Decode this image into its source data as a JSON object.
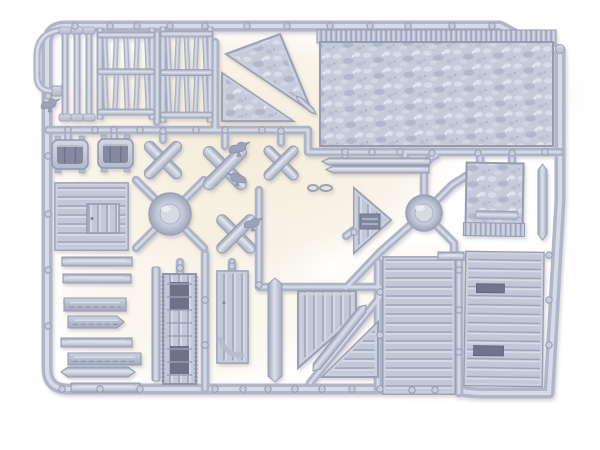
{
  "scene": {
    "description": "Photograph of a light grey plastic injection-moulded sprue (model kit frame) holding wooden-terrain parts: plank panels, picket fence gates, thatched roof sections, X-shaped barricade braces, posts, troughs, a ladder, doors and small perched crows, on a plain white background.",
    "palette": {
      "background": "#ffffff",
      "surface_tint": "#f3ebd6",
      "plastic_base": "#c3c8d8",
      "plastic_highlight": "#dde1ea",
      "plastic_shadow": "#9aa1b8",
      "plastic_dark": "#6f7489"
    }
  },
  "parts": [
    {
      "name": "hanging-hook",
      "kind": "stroke",
      "d": "M62,30 Q37,32 37,56 L37,76 Q37,89 49,91 L58,91",
      "w": 7
    },
    {
      "name": "hook-foot",
      "kind": "rect",
      "x": 52,
      "y": 86,
      "w": 10,
      "h": 10,
      "grad": "p"
    },
    {
      "name": "crow-figure-left",
      "kind": "crow",
      "x": 40,
      "y": 98,
      "s": 1.0,
      "flip": false
    },
    {
      "name": "fence-posts",
      "kind": "posts",
      "x": 62,
      "y": 27,
      "w": 30,
      "h": 94,
      "n": 3
    },
    {
      "name": "fence-gate-a",
      "kind": "gate",
      "x": 97,
      "y": 26,
      "w": 58,
      "h": 95,
      "pickets": 5
    },
    {
      "name": "fence-gate-b",
      "kind": "gate",
      "x": 160,
      "y": 25,
      "w": 53,
      "h": 99,
      "pickets": 5
    },
    {
      "name": "gable-thatch-wedge",
      "kind": "poly",
      "pts": [
        [
          226,
          54
        ],
        [
          280,
          34
        ],
        [
          312,
          112
        ]
      ],
      "fill": "th",
      "beam": true
    },
    {
      "name": "wedge-tip-spike",
      "kind": "diagplank",
      "x1": 296,
      "y1": 96,
      "x2": 316,
      "y2": 114,
      "w": 5
    },
    {
      "name": "gable-thatch-corner",
      "kind": "poly",
      "pts": [
        [
          222,
          73
        ],
        [
          222,
          121
        ],
        [
          293,
          121
        ]
      ],
      "fill": "th",
      "beam": true
    },
    {
      "name": "thatch-roof-large",
      "kind": "thatch",
      "x": 320,
      "y": 30,
      "w": 233,
      "h": 116,
      "fringe": "top"
    },
    {
      "name": "thin-plank-a",
      "kind": "plank",
      "x": 322,
      "y": 158,
      "w": 108,
      "h": 7,
      "point": "left"
    },
    {
      "name": "thin-plank-b",
      "kind": "plank",
      "x": 326,
      "y": 166,
      "w": 103,
      "h": 7,
      "point": "left"
    },
    {
      "name": "thatch-roof-small",
      "kind": "thatch",
      "x": 466,
      "y": 163,
      "w": 57,
      "h": 73,
      "fringe": "bottom",
      "bar": [
        476,
        211,
        42,
        8
      ],
      "rot": 1
    },
    {
      "name": "plank-vertical-right",
      "kind": "vplank",
      "x": 538,
      "y": 164,
      "w": 9,
      "h": 76
    },
    {
      "name": "water-trough-a",
      "kind": "trough",
      "x": 52,
      "y": 140,
      "w": 36,
      "h": 29
    },
    {
      "name": "water-trough-b",
      "kind": "trough",
      "x": 98,
      "y": 139,
      "w": 35,
      "h": 29
    },
    {
      "name": "x-brace-a",
      "kind": "xbrace",
      "cx": 163,
      "cy": 160,
      "arm": 24,
      "w": 11
    },
    {
      "name": "x-brace-b",
      "kind": "xbrace",
      "cx": 225,
      "cy": 168,
      "arm": 28,
      "w": 12
    },
    {
      "name": "crow-on-brace-b",
      "kind": "crow",
      "x": 228,
      "y": 141,
      "s": 1.1,
      "flip": false
    },
    {
      "name": "crow-under-brace-b",
      "kind": "crow",
      "x": 227,
      "y": 172,
      "s": 1.0,
      "flip": true
    },
    {
      "name": "x-brace-c",
      "kind": "xbrace",
      "cx": 281,
      "cy": 163,
      "arm": 22,
      "w": 10
    },
    {
      "name": "x-brace-d",
      "kind": "xbrace",
      "cx": 236,
      "cy": 234,
      "arm": 25,
      "w": 11
    },
    {
      "name": "crow-on-brace-d",
      "kind": "crow",
      "x": 243,
      "y": 217,
      "s": 1.0,
      "flip": false
    },
    {
      "name": "moulding-hub-left",
      "kind": "hub",
      "cx": 170,
      "cy": 214,
      "r": 21,
      "ri": 10
    },
    {
      "name": "moulding-hub-right",
      "kind": "hub",
      "cx": 424,
      "cy": 213,
      "r": 18,
      "ri": 9
    },
    {
      "name": "shed-wall-panel",
      "kind": "panel",
      "x": 55,
      "y": 183,
      "w": 73,
      "h": 67,
      "dir": "h",
      "door": [
        87,
        204,
        32,
        29
      ]
    },
    {
      "name": "plank-long-a",
      "kind": "plank",
      "x": 62,
      "y": 257,
      "w": 70,
      "h": 9
    },
    {
      "name": "plank-long-b",
      "kind": "plank",
      "x": 63,
      "y": 274,
      "w": 68,
      "h": 9
    },
    {
      "name": "log-plank-a",
      "kind": "plank",
      "x": 64,
      "y": 298,
      "w": 62,
      "h": 13,
      "style": "log"
    },
    {
      "name": "log-plank-b",
      "kind": "plank",
      "x": 68,
      "y": 316,
      "w": 56,
      "h": 12,
      "style": "log",
      "point": "right"
    },
    {
      "name": "plank-long-c",
      "kind": "plank",
      "x": 61,
      "y": 338,
      "w": 71,
      "h": 9
    },
    {
      "name": "log-plank-c",
      "kind": "plank",
      "x": 68,
      "y": 353,
      "w": 73,
      "h": 12,
      "style": "log"
    },
    {
      "name": "plank-pointed",
      "kind": "plank",
      "x": 61,
      "y": 367,
      "w": 74,
      "h": 10,
      "point": "both"
    },
    {
      "name": "plank-long-d",
      "kind": "plank",
      "x": 71,
      "y": 383,
      "w": 69,
      "h": 9
    },
    {
      "name": "support-beam",
      "kind": "rect",
      "x": 152,
      "y": 267,
      "w": 8,
      "h": 114,
      "grad": "v"
    },
    {
      "name": "ladder",
      "kind": "ladder",
      "x": 163,
      "y": 274,
      "w": 33,
      "h": 110
    },
    {
      "name": "door-with-brace",
      "kind": "doorarc",
      "x": 217,
      "y": 271,
      "w": 31,
      "h": 92
    },
    {
      "name": "spear-plank",
      "kind": "vplank",
      "x": 268,
      "y": 278,
      "w": 14,
      "h": 104
    },
    {
      "name": "gate-panel-cut",
      "kind": "poly",
      "pts": [
        [
          298,
          291
        ],
        [
          356,
          291
        ],
        [
          356,
          317
        ],
        [
          298,
          368
        ]
      ],
      "fill": "pV",
      "beam": true
    },
    {
      "name": "diagonal-plank",
      "kind": "diagplank",
      "x1": 313,
      "y1": 371,
      "x2": 366,
      "y2": 305,
      "w": 9
    },
    {
      "name": "corner-panel-triangle",
      "kind": "poly",
      "pts": [
        [
          322,
          377
        ],
        [
          378,
          377
        ],
        [
          378,
          322
        ]
      ],
      "fill": "pH",
      "beam": true
    },
    {
      "name": "gable-end-planked",
      "kind": "gable",
      "pts": [
        [
          354,
          188
        ],
        [
          354,
          253
        ],
        [
          391,
          220
        ]
      ],
      "win": [
        360,
        214,
        20,
        15
      ]
    },
    {
      "name": "plank-panel-large-a",
      "kind": "panel",
      "x": 383,
      "y": 257,
      "w": 72,
      "h": 137,
      "dir": "h"
    },
    {
      "name": "plank-panel-large-b",
      "kind": "panel",
      "x": 465,
      "y": 252,
      "w": 78,
      "h": 134,
      "dir": "h",
      "rot": 0.8,
      "slots": [
        [
          476,
          284,
          28,
          9
        ],
        [
          474,
          346,
          30,
          10
        ]
      ]
    },
    {
      "name": "stub-plank",
      "kind": "plank",
      "x": 438,
      "y": 252,
      "w": 26,
      "h": 8
    },
    {
      "name": "wire-link",
      "kind": "link",
      "cx": 320,
      "cy": 188
    }
  ],
  "nubs": [
    [
      75,
      26
    ],
    [
      110,
      26
    ],
    [
      137,
      26
    ],
    [
      170,
      26
    ],
    [
      205,
      26
    ],
    [
      247,
      26
    ],
    [
      287,
      26
    ],
    [
      330,
      26
    ],
    [
      370,
      26
    ],
    [
      408,
      26
    ],
    [
      452,
      26
    ],
    [
      492,
      26
    ],
    [
      68,
      130
    ],
    [
      95,
      130
    ],
    [
      114,
      130
    ],
    [
      140,
      130
    ],
    [
      163,
      131
    ],
    [
      196,
      130
    ],
    [
      225,
      130
    ],
    [
      262,
      130
    ],
    [
      281,
      131
    ],
    [
      345,
      152
    ],
    [
      372,
      152
    ],
    [
      400,
      152
    ],
    [
      432,
      153
    ],
    [
      478,
      153
    ],
    [
      512,
      153
    ],
    [
      545,
      152
    ],
    [
      48,
      96
    ],
    [
      48,
      156
    ],
    [
      48,
      214
    ],
    [
      48,
      270
    ],
    [
      48,
      326
    ],
    [
      62,
      389
    ],
    [
      100,
      389
    ],
    [
      140,
      389
    ],
    [
      215,
      389
    ],
    [
      243,
      389
    ],
    [
      268,
      389
    ],
    [
      295,
      389
    ],
    [
      322,
      389
    ],
    [
      352,
      389
    ],
    [
      380,
      389
    ],
    [
      412,
      390
    ],
    [
      435,
      390
    ],
    [
      459,
      270
    ],
    [
      459,
      310
    ],
    [
      459,
      352
    ],
    [
      549,
      255
    ],
    [
      549,
      300
    ],
    [
      549,
      345
    ],
    [
      380,
      292
    ],
    [
      380,
      335
    ],
    [
      259,
      285
    ],
    [
      205,
      300
    ],
    [
      205,
      345
    ],
    [
      232,
      266
    ],
    [
      180,
      268
    ],
    [
      354,
      232
    ]
  ]
}
